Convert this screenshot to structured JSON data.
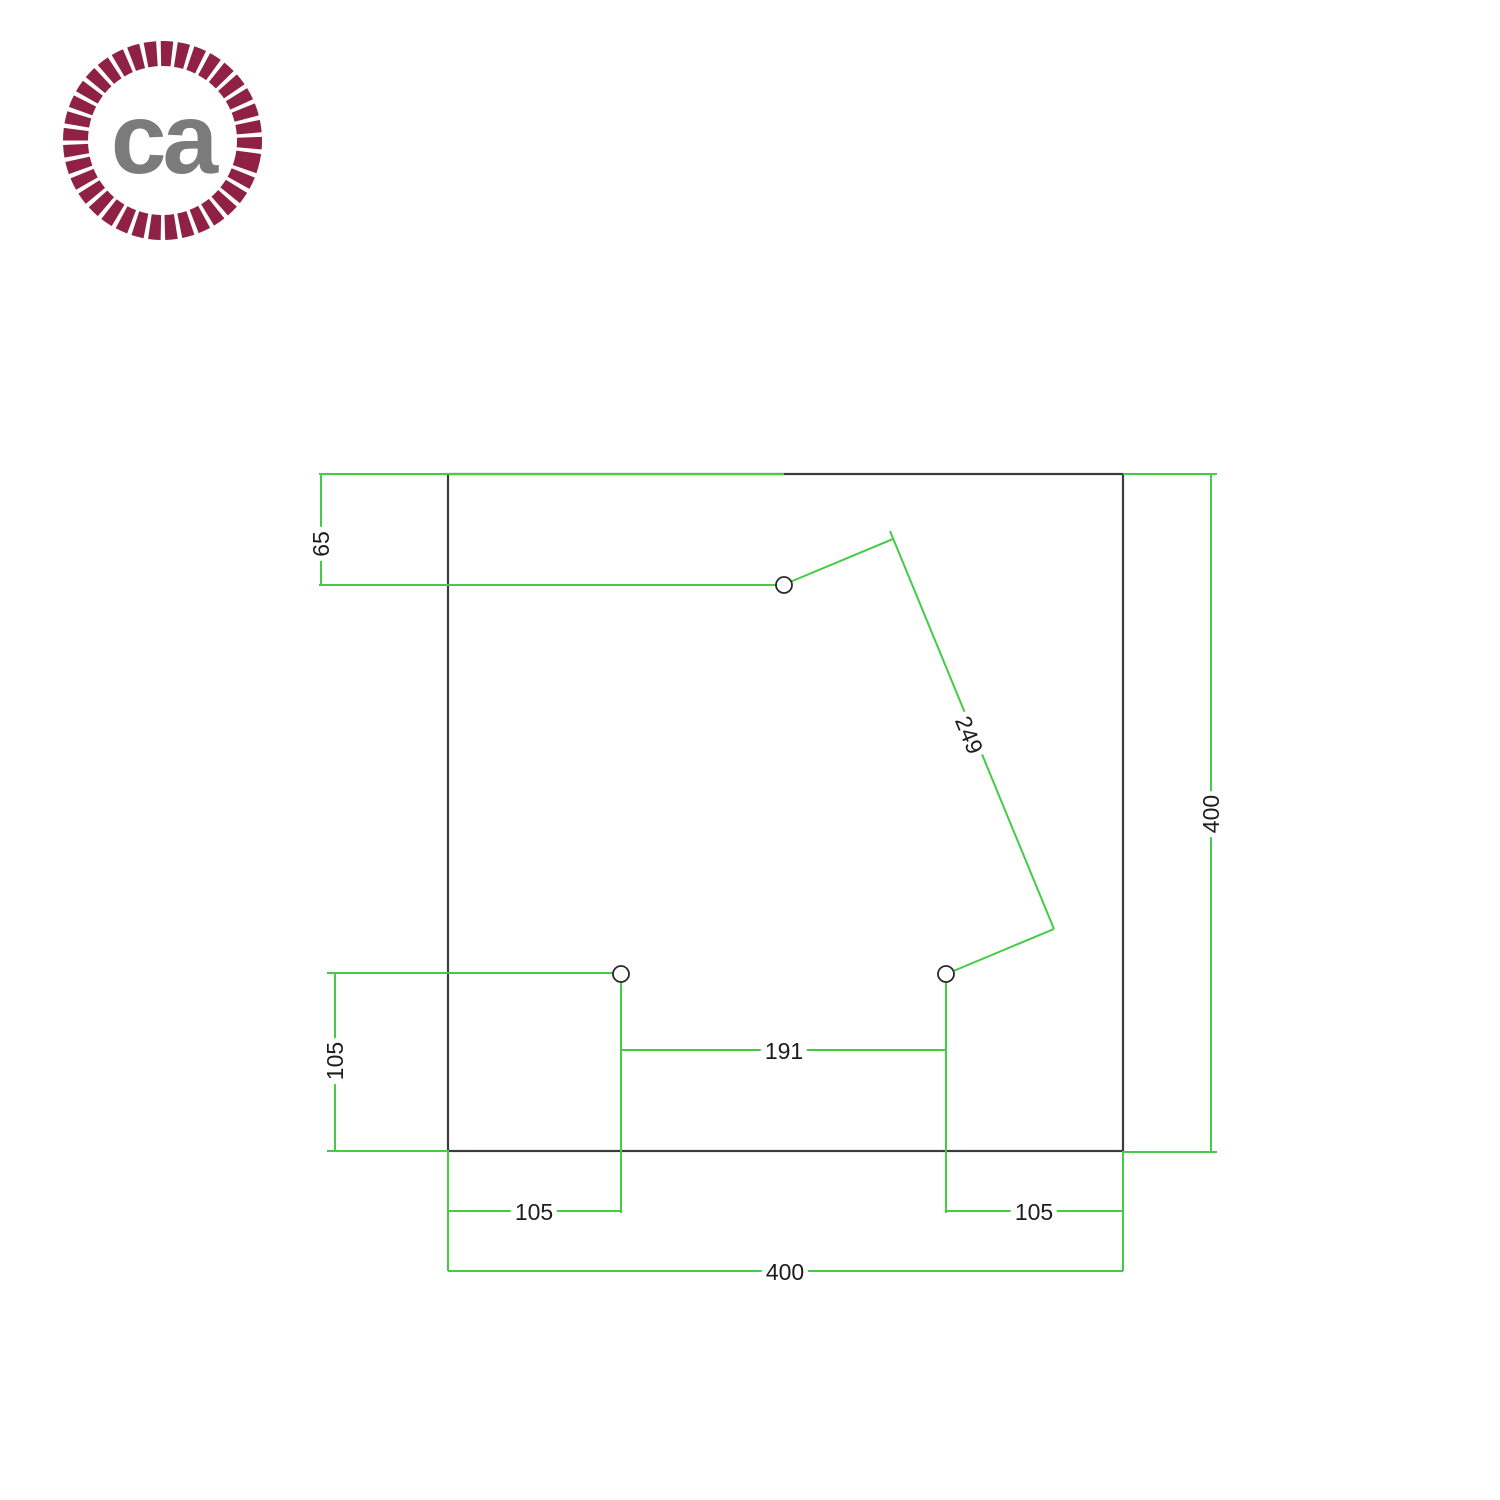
{
  "logo": {
    "text": "ca",
    "ring_color": "#8e2144",
    "text_color": "#7b7b7b"
  },
  "colors": {
    "dimension_line": "#44cc44",
    "plate_outline": "#3c3c3c",
    "hole_outline": "#2b2b2b",
    "label_text": "#1d1d1d",
    "background": "#ffffff"
  },
  "diagram": {
    "type": "dimension-drawing",
    "plate_width": 400,
    "plate_height": 400,
    "hole_count": 3,
    "dimensions": [
      {
        "name": "top-hole-offset-from-top-edge",
        "value": 65
      },
      {
        "name": "bottom-left-hole-offset-from-left-edge",
        "value": 105
      },
      {
        "name": "bottom-left-hole-offset-from-bottom-edge",
        "value": 105
      },
      {
        "name": "bottom-right-hole-offset-from-right-edge",
        "value": 105
      },
      {
        "name": "bottom-holes-horizontal-spacing",
        "value": 191
      },
      {
        "name": "top-hole-to-bottom-right-hole-distance",
        "value": 249
      },
      {
        "name": "plate-width",
        "value": 400
      },
      {
        "name": "plate-height",
        "value": 400
      }
    ]
  },
  "labels": [
    {
      "id": "dim-65",
      "text": "65"
    },
    {
      "id": "dim-105-left",
      "text": "105"
    },
    {
      "id": "dim-191",
      "text": "191"
    },
    {
      "id": "dim-249",
      "text": "249"
    },
    {
      "id": "dim-105-bottom-left",
      "text": "105"
    },
    {
      "id": "dim-105-bottom-right",
      "text": "105"
    },
    {
      "id": "dim-400-bottom",
      "text": "400"
    },
    {
      "id": "dim-400-right",
      "text": "400"
    }
  ]
}
